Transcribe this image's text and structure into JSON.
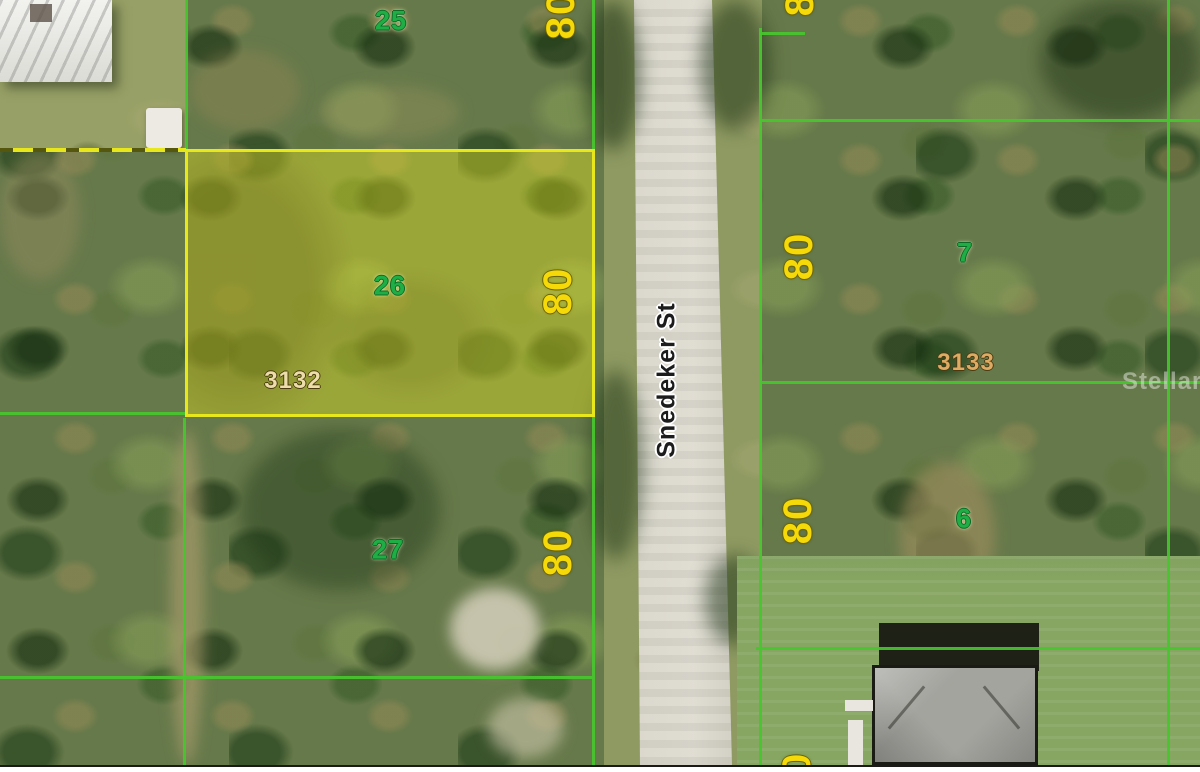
{
  "map": {
    "street_label": "Snedeker St",
    "watermark": "StellarMLS",
    "lots": {
      "lot_25": "25",
      "lot_26": "26",
      "lot_27": "27",
      "lot_7": "7",
      "lot_6": "6"
    },
    "parcels": {
      "id_3132": "3132",
      "id_3133": "3133"
    },
    "dimensions": {
      "d25": "80",
      "d26": "80",
      "d27": "80",
      "d7_top": "80",
      "d7": "80",
      "d6": "80",
      "d_bottom": "80"
    },
    "colors": {
      "boundary_line": "#46c72e",
      "highlight_yellow": "#e7e71c",
      "dimension_text": "#f6d908",
      "lot_number_text": "#1fae46",
      "parcel_id_text": "#ecddab",
      "street_text": "#1c1c1c"
    }
  }
}
